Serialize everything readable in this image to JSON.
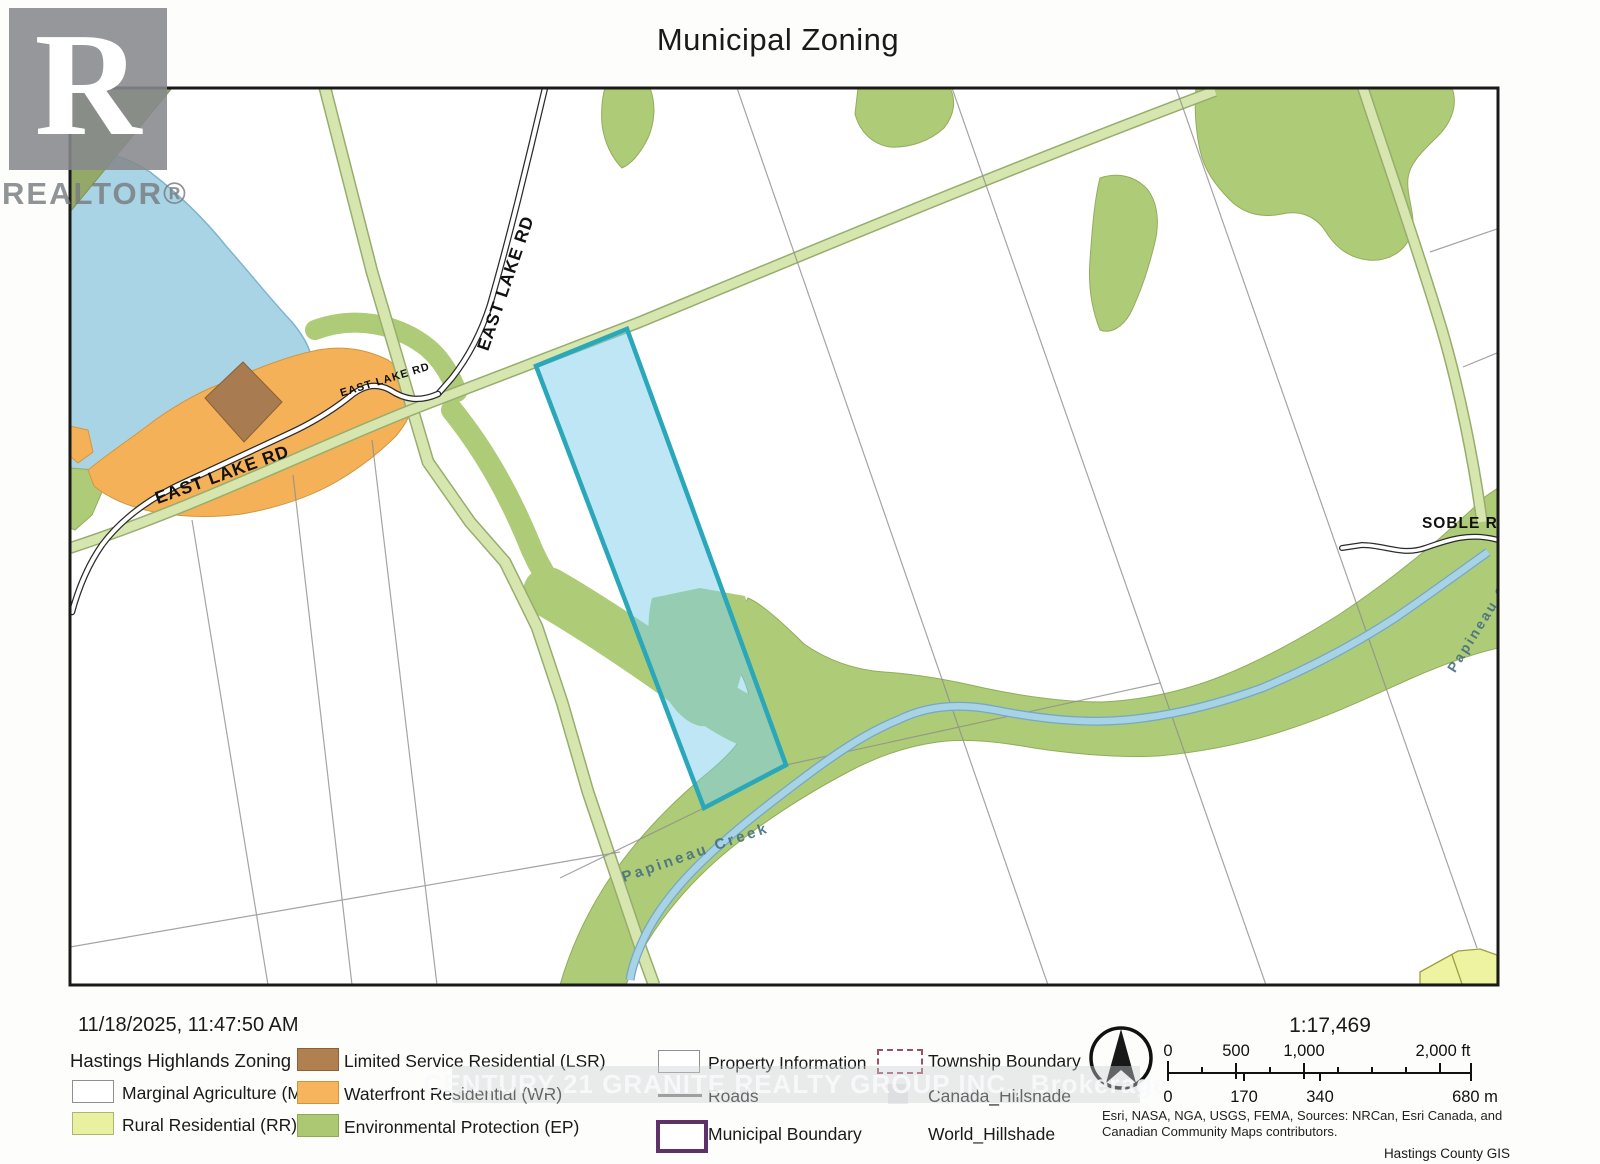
{
  "title": "Municipal Zoning",
  "logo": {
    "letter": "R",
    "wordmark": "REALTOR®"
  },
  "map": {
    "roads": {
      "east_lake_rd": "EAST LAKE RD",
      "soble_rd": "SOBLE RD"
    },
    "creek_name": "Papineau Creek",
    "colors": {
      "lake": "#a9d4e6",
      "waterfront_residential": "#f4b158",
      "limited_service_residential": "#a87c50",
      "environmental_protection": "#aecb77",
      "rural_residential": "#eef3a2",
      "road_allowance": "#d6e6ae",
      "subject_parcel_fill": "rgba(125,205,235,0.5)",
      "subject_parcel_outline": "#2aa7b8",
      "municipal_boundary": "#5e3268",
      "township_boundary": "#9c4f66"
    }
  },
  "footer": {
    "timestamp": "11/18/2025, 11:47:50 AM",
    "legend_title": "Hastings Highlands Zoning",
    "legend": {
      "ma": "Marginal Agriculture (MA)",
      "rr": "Rural Residential (RR)",
      "lsr": "Limited Service Residential (LSR)",
      "wr": "Waterfront Residential (WR)",
      "ep": "Environmental Protection (EP)",
      "property_information": "Property Information",
      "roads": "Roads",
      "municipal_boundary": "Municipal Boundary",
      "township_boundary": "Township Boundary",
      "canada_hillshade": "Canada_Hillshade",
      "world_hillshade": "World_Hillshade"
    },
    "scale": {
      "ratio": "1:17,469",
      "ft": [
        "0",
        "500",
        "1,000",
        "2,000 ft"
      ],
      "m": [
        "0",
        "170",
        "340",
        "680 m"
      ]
    },
    "attribution_line1": "Esri, NASA, NGA, USGS, FEMA, Sources: NRCan, Esri Canada, and",
    "attribution_line2": "Canadian Community Maps contributors.",
    "credit": "Hastings County GIS"
  },
  "watermark": "CENTURY 21 GRANITE REALTY GROUP INC., Brokerage"
}
